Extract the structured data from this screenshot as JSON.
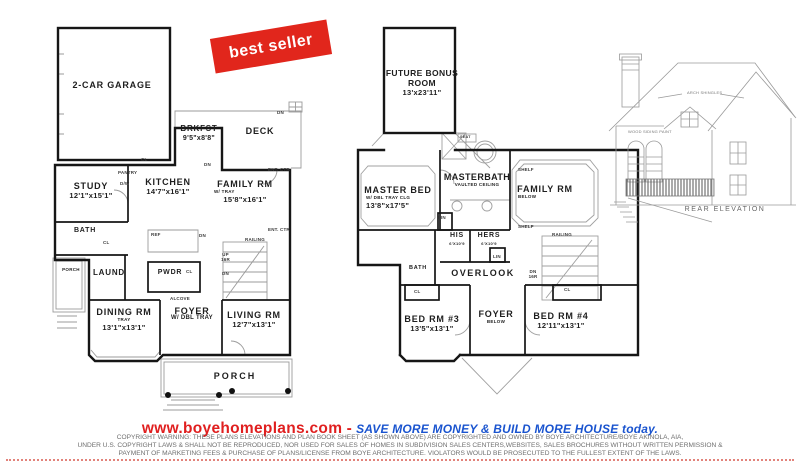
{
  "banner": {
    "label": "best seller"
  },
  "floor1": {
    "garage": {
      "name": "2-CAR GARAGE"
    },
    "brkfst": {
      "name": "BRKFST",
      "dim": "9'5\"x8'8\""
    },
    "deck": {
      "name": "DECK"
    },
    "study": {
      "name": "STUDY",
      "dim": "12'1\"x15'1\""
    },
    "kitchen": {
      "name": "KITCHEN",
      "dim": "14'7\"x16'1\""
    },
    "family": {
      "name": "FAMILY RM",
      "sub": "W/ TRAY",
      "dim": "15'8\"x16'1\""
    },
    "bath": {
      "name": "BATH"
    },
    "laund": {
      "name": "LAUND"
    },
    "powdr": {
      "name": "PWDR"
    },
    "side_porch": {
      "name": "PORCH"
    },
    "dining": {
      "name": "DINING RM",
      "sub": "TRAY",
      "dim": "13'1\"x13'1\""
    },
    "foyer": {
      "name": "FOYER",
      "sub": "W/ DBL TRAY"
    },
    "living": {
      "name": "LIVING RM",
      "dim": "12'7\"x13'1\""
    },
    "porch": {
      "name": "PORCH"
    },
    "tags": {
      "cl": "CL",
      "dn": "DN",
      "up16r": "UP 16R",
      "pantry": "PANTRY",
      "dw": "D/W",
      "ref": "REF",
      "railing": "RAILING",
      "ent_ctr": "ENT. CTR",
      "alcove": "ALCOVE"
    }
  },
  "floor2": {
    "bonus": {
      "name": "FUTURE BONUS ROOM",
      "dim": "13'x23'11\""
    },
    "master": {
      "name": "MASTER BED",
      "sub": "W/ DBL TRAY CLG",
      "dim": "13'8\"x17'5\""
    },
    "masterbath": {
      "name": "MASTERBATH",
      "sub": "VAULTED CEILING"
    },
    "family": {
      "name": "FAMILY RM",
      "sub": "BELOW"
    },
    "his": {
      "name": "HIS",
      "dim": "6'X10'9"
    },
    "hers": {
      "name": "HERS",
      "dim": "6'X10'9"
    },
    "overlook": {
      "name": "OVERLOOK"
    },
    "bath": {
      "name": "BATH"
    },
    "bed3": {
      "name": "BED RM #3",
      "dim": "13'5\"x13'1\""
    },
    "foyer": {
      "name": "FOYER",
      "sub": "BELOW"
    },
    "bed4": {
      "name": "BED RM #4",
      "dim": "12'11\"x13'1\""
    },
    "tags": {
      "seat": "SEAT",
      "shelf": "SHELF",
      "lin": "LIN",
      "railing": "RAILING",
      "dn16r": "DN 16R",
      "cl": "CL"
    }
  },
  "elevation": {
    "title": "REAR ELEVATION",
    "label_shingles": "ARCH SHINGLES",
    "label_siding": "WOOD SIDING PAINT"
  },
  "footer": {
    "website": "www.boyehomeplans.com",
    "separator": " - ",
    "slogan": "SAVE MORE MONEY & BUILD MORE HOUSE today.",
    "copyright": [
      "COPYRIGHT WARNING: THESE PLANS ELEVATIONS AND PLAN BOOK SHEET (AS SHOWN ABOVE) ARE COPYRIGHTED AND OWNED BY BOYE ARCHITECTURE/BOYE AKINOLA, AIA,",
      "UNDER U.S. COPYRIGHT LAWS & SHALL NOT BE REPRODUCED, NOR USED FOR SALES OF HOMES IN SUBDIVISION SALES CENTERS,WEBSITES, SALES BROCHURES WITHOUT WRITTEN PERMISSION &",
      "PAYMENT OF MARKETING FEES & PURCHASE OF PLANS/LICENSE FROM BOYE ARCHITECTURE. VIOLATORS WOULD BE PROSECUTED TO THE FULLEST EXTENT OF THE LAWS."
    ]
  },
  "colors": {
    "banner_red": "#e1261c",
    "website_red": "#e01f1f",
    "slogan_blue": "#1a54cf",
    "copyright_gray": "#6f6f6f",
    "wall_black": "#161616",
    "detail_gray": "#9b9b9b"
  }
}
